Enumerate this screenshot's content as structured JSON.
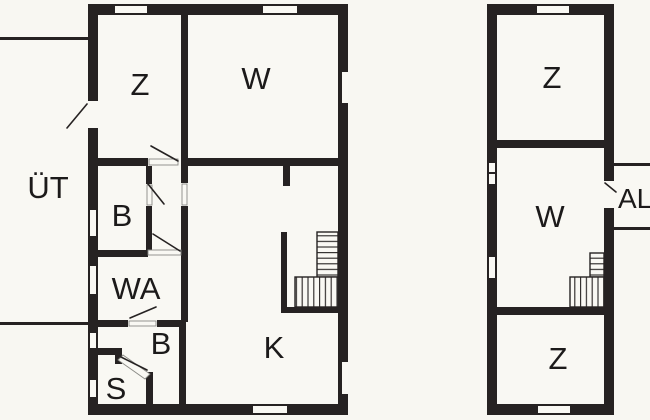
{
  "colors": {
    "wall": "#262222",
    "floor": "#f9f8f3",
    "label": "#1c1a1a",
    "leaf_stroke": "#8a8a85",
    "page_bg": "#f8f7f2"
  },
  "left_plan": {
    "rooms": {
      "z": "Z",
      "w": "W",
      "uet": "ÜT",
      "b_upper": "B",
      "wa": "WA",
      "b_lower": "B",
      "s": "S",
      "k": "K"
    }
  },
  "right_plan": {
    "rooms": {
      "z_top": "Z",
      "w": "W",
      "al": "AL",
      "z_bottom": "Z"
    }
  }
}
